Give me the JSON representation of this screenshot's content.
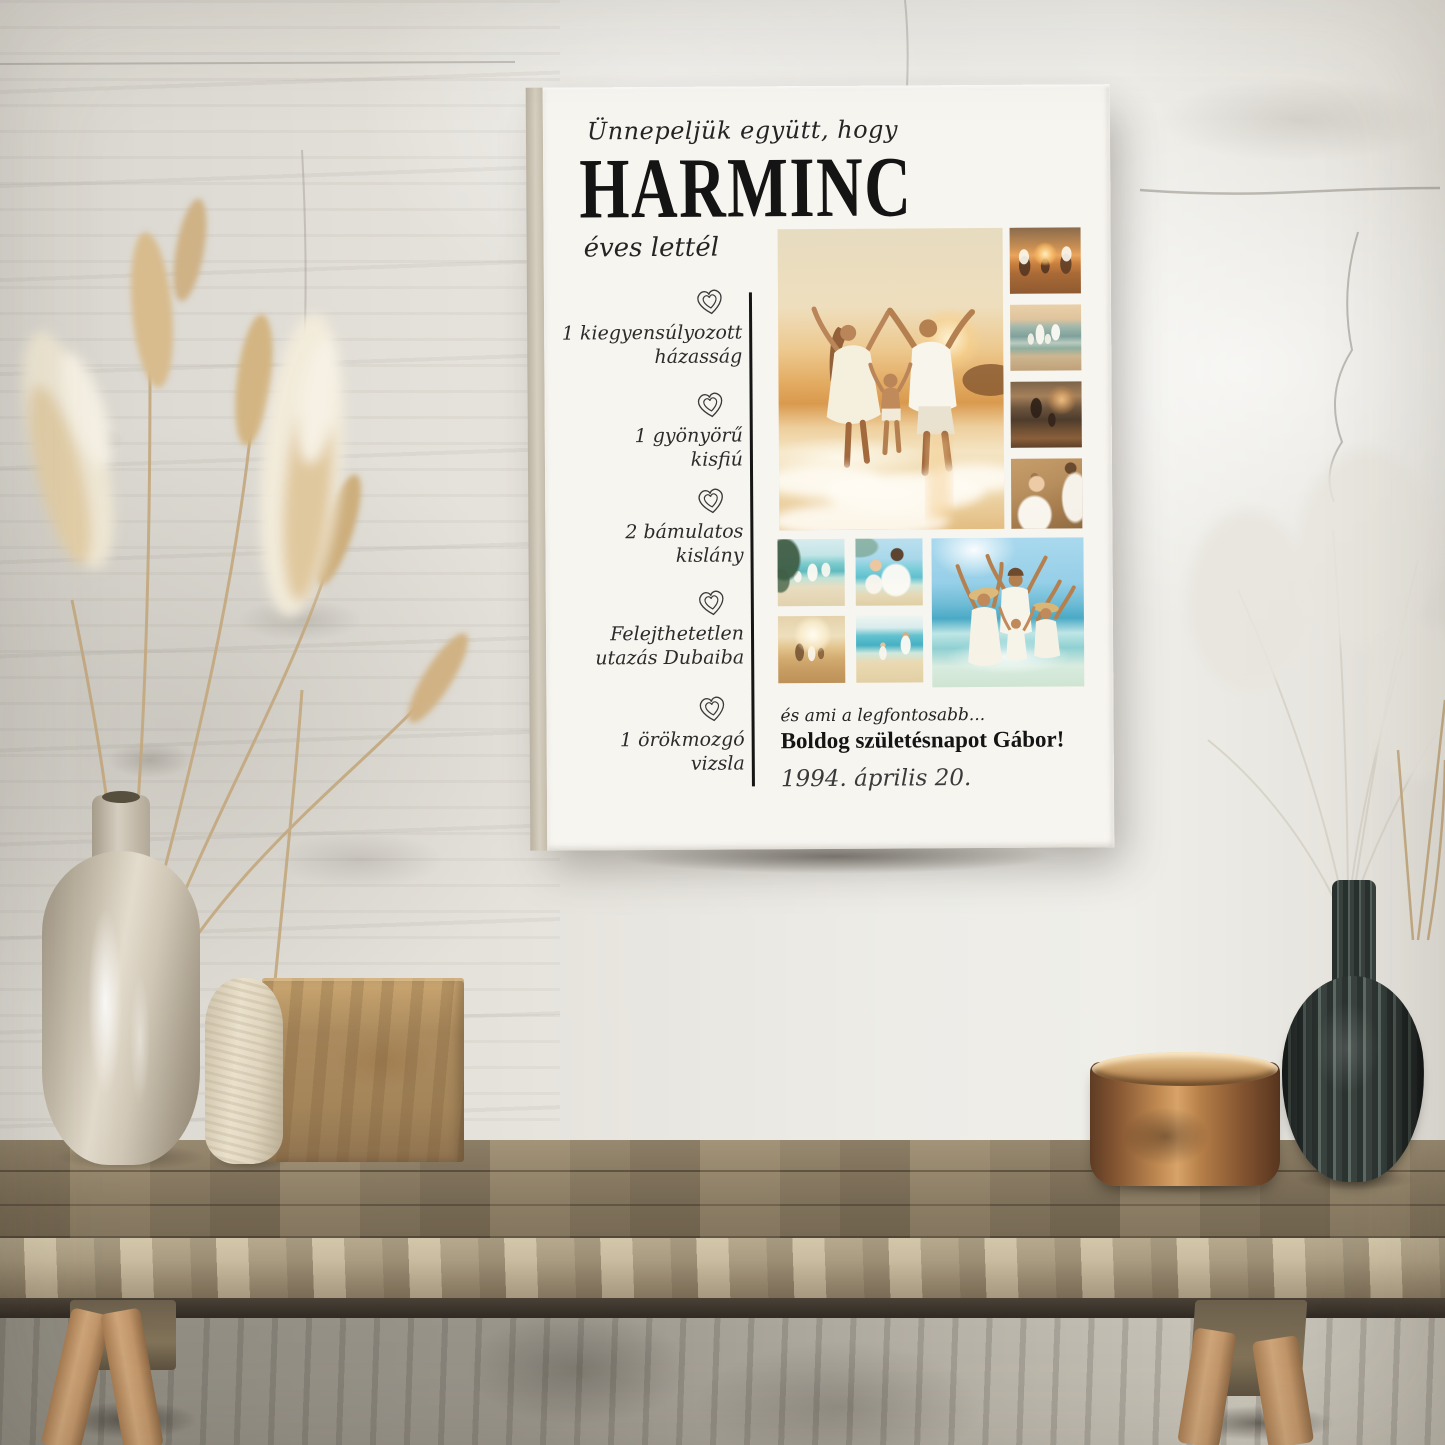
{
  "poster": {
    "intro": "Ünnepeljük együtt, hogy",
    "headline": "HARMINC",
    "subline": "éves lettél",
    "milestones": [
      {
        "line1": "1 kiegyensúlyozott",
        "line2": "házasság"
      },
      {
        "line1": "1 gyönyörű",
        "line2": "kisfiú"
      },
      {
        "line1": "2 bámulatos",
        "line2": "kislány"
      },
      {
        "line1": "Felejthetetlen",
        "line2": "utazás Dubaiba"
      },
      {
        "line1": "1 örökmozgó",
        "line2": "vizsla"
      }
    ],
    "closing": {
      "lead": "és ami a legfontosabb...",
      "message": "Boldog születésnapot Gábor!",
      "date": "1994. április 20."
    },
    "photo_collage": {
      "main": "family-of-three-sunset-beach",
      "side_column": [
        "family-running-sunset-surf",
        "family-walking-into-sea-sunset",
        "mother-and-child-dusk-beach",
        "girl-in-white-dress-with-father"
      ],
      "bottom_grid": [
        "father-playing-with-children-tropical-beach",
        "father-daughter-beach-selfie",
        "family-walking-backlit-beach",
        "father-daughter-running-turquoise-sea"
      ],
      "bottom_large": "family-of-four-straw-hats-waving"
    },
    "colors": {
      "poster_background": "#f7f5f0",
      "text": "#1c1c1c",
      "heart_outline": "#3a3a3a",
      "divider": "#161616"
    }
  },
  "scene": {
    "objects": [
      "pampas-grass-left",
      "tall-ceramic-vase",
      "small-stone-vessel",
      "wooden-block",
      "rustic-wood-bench",
      "copper-bowl",
      "ribbed-charcoal-vase",
      "dried-grass-right"
    ]
  }
}
